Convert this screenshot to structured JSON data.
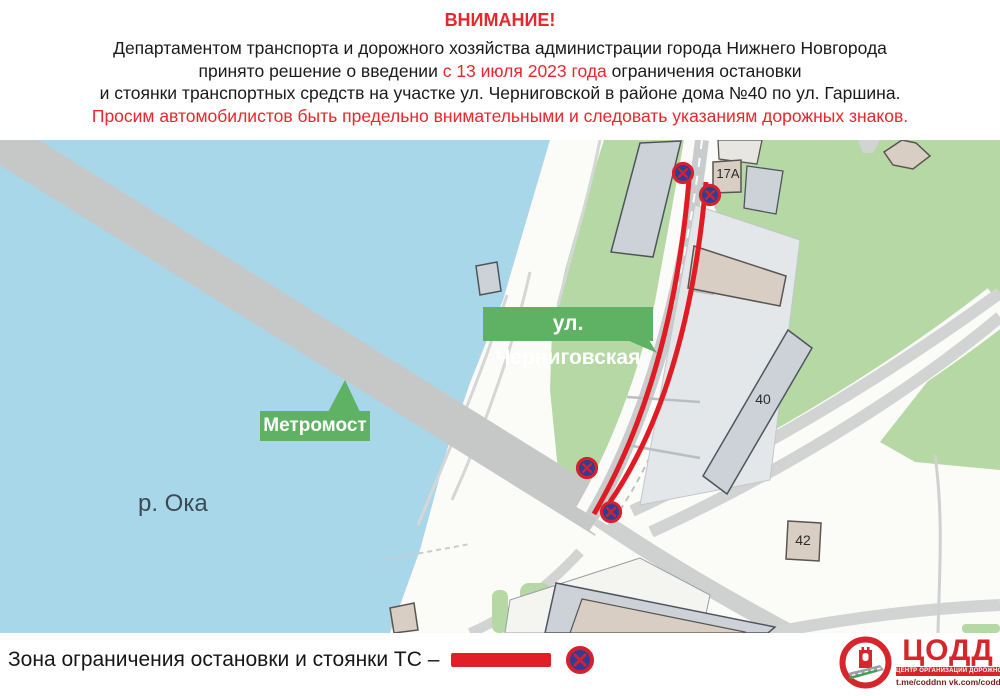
{
  "header": {
    "title": "ВНИМАНИЕ!",
    "line1": "Департаментом транспорта и дорожного хозяйства администрации города Нижнего Новгорода",
    "line2_prefix": "принято решение о введении ",
    "line2_highlight": "с 13 июля 2023 года",
    "line2_suffix": " ограничения остановки",
    "line3": "и стоянки транспортных средств на участке ул. Черниговской в районе дома №40 по ул. Гаршина.",
    "line4": "Просим автомобилистов быть предельно внимательными и следовать указаниям дорожных знаков."
  },
  "map": {
    "street_label": "ул. Черниговская",
    "bridge_label": "Метромост",
    "river_label": "р. Ока",
    "buildings": {
      "b17a": "17А",
      "b40": "40",
      "b42": "42"
    }
  },
  "legend": {
    "label": "Зона ограничения остановки и стоянки ТС –"
  },
  "logo": {
    "title": "ЦОДД",
    "subtitle": "ЦЕНТР ОРГАНИЗАЦИИ ДОРОЖНОГО ДВИЖЕНИЯ",
    "links": "t.me/coddnn vk.com/coddnn52"
  },
  "colors": {
    "accent_red": "#e8262d",
    "restriction_red": "#e11b24",
    "label_green": "#5fb263",
    "map_green": "#b5d8a5",
    "water_blue": "#a9d7ea",
    "logo_red": "#d6252b",
    "sign_blue": "#2e3e96"
  }
}
